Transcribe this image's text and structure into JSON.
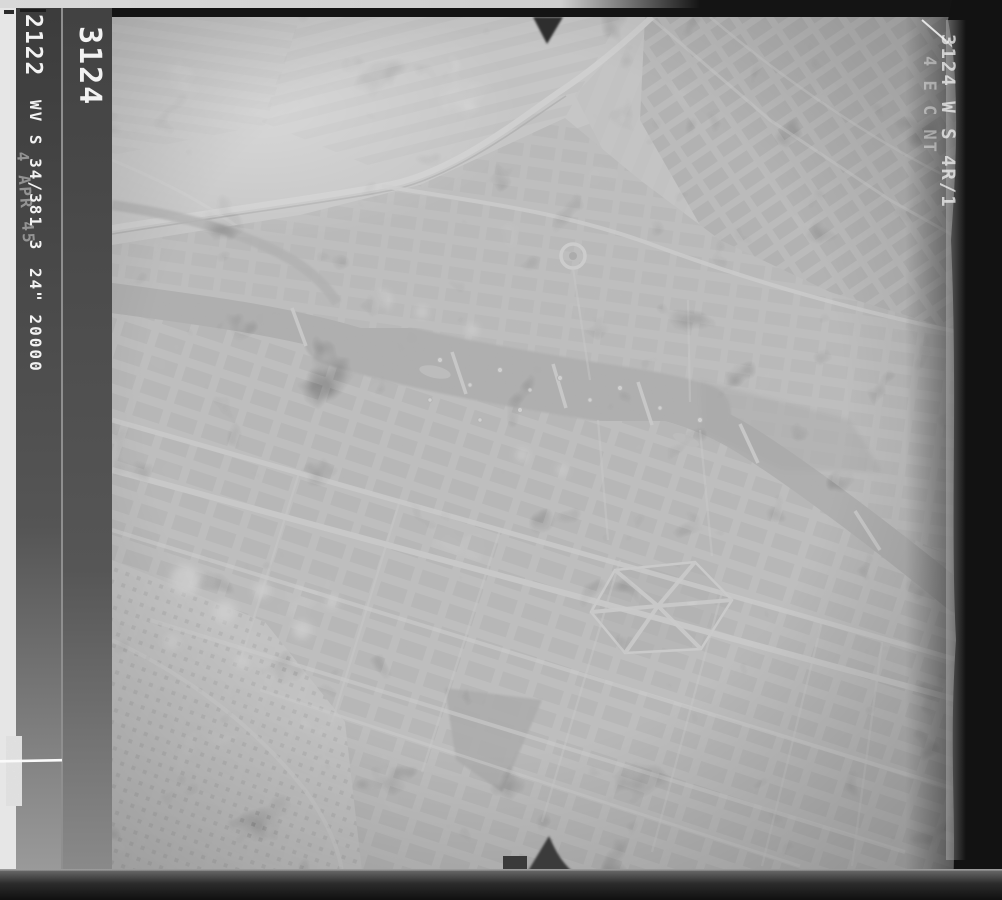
{
  "photo": {
    "kind": "aerial-reconnaissance-photograph",
    "annotations": {
      "frame_number_left": "3124",
      "film_number": "2122",
      "sortie_line": "WV S 34/381 3",
      "date_line": "4 APR 45",
      "lens_scale_line": "24\" 20000",
      "right_ghost_line1": "3124 W S 4R/1",
      "right_ghost_line2": "4 E C NT"
    },
    "colors": {
      "film_border_black": "#141414",
      "margin_white": "#e6e6e6",
      "film_strip_dark": "#454545",
      "photo_mid_gray": "#a6a6a6",
      "fields_light_gray": "#c6c6c6",
      "river_dark_gray": "#5e5e5e",
      "annotation_white": "#f2f2f2",
      "bottom_band_gray": "#2a2a2a"
    }
  }
}
